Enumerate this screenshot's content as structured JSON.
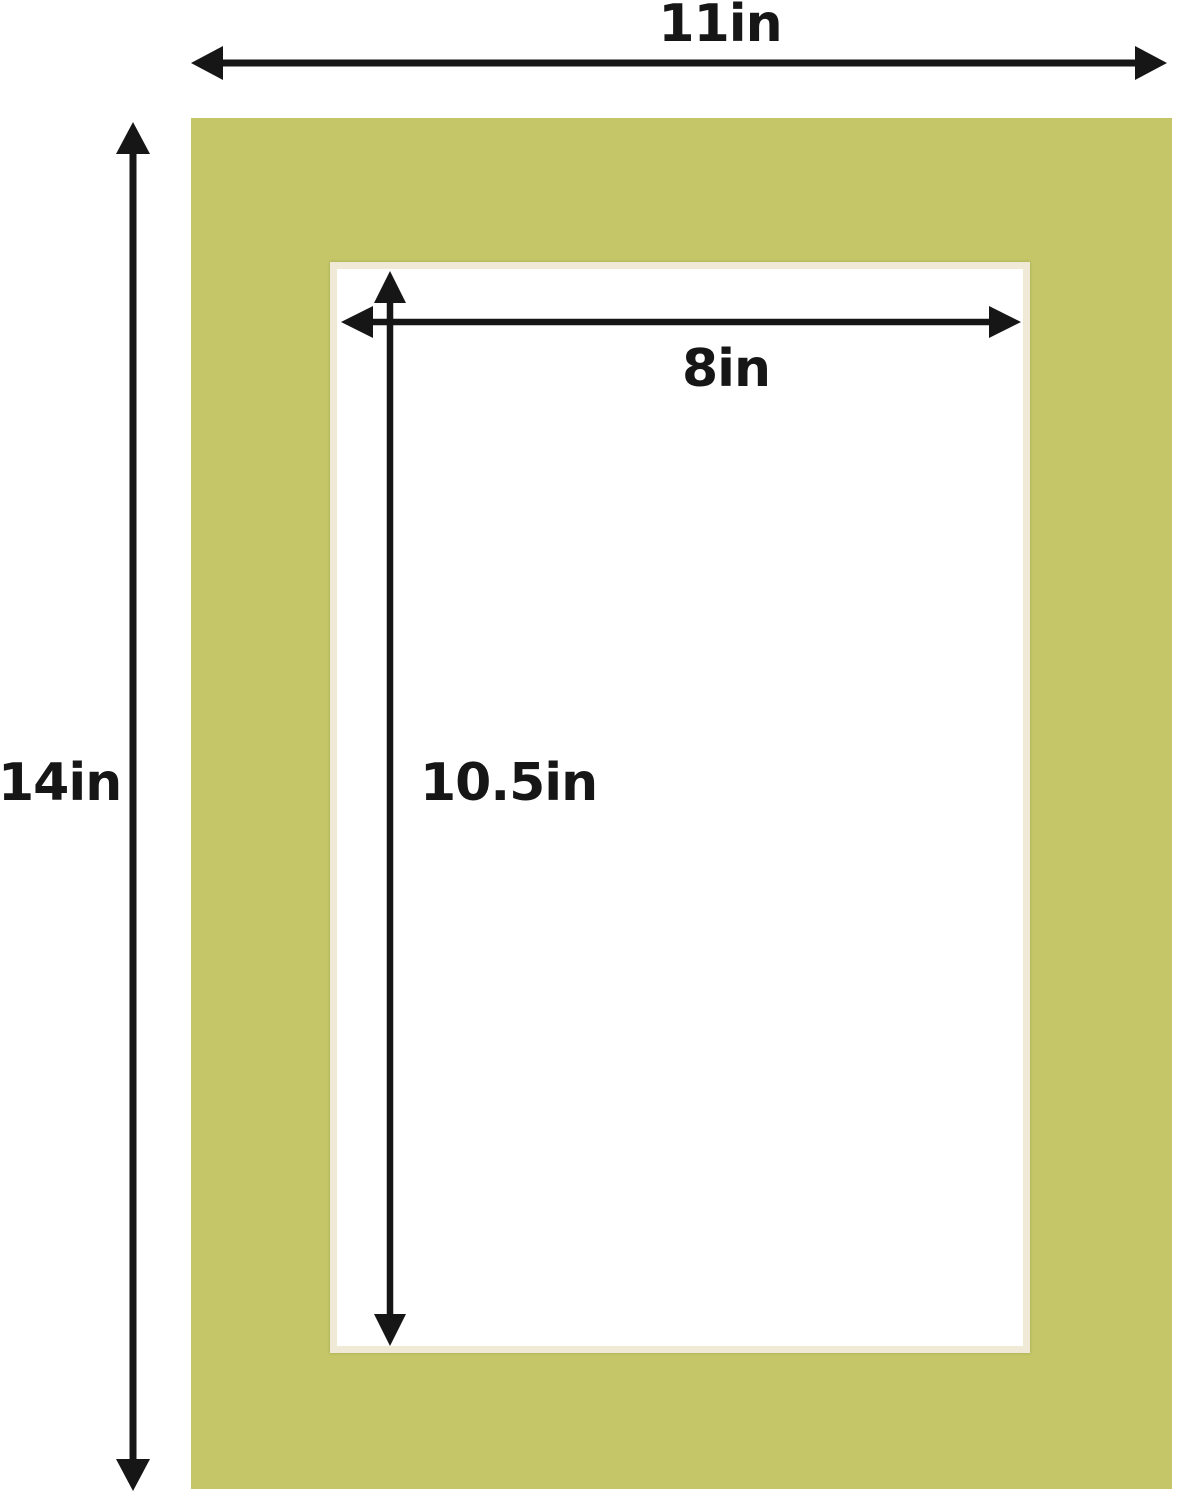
{
  "image": {
    "description": "Dimension diagram of a picture frame mat board with a rectangular cut opening",
    "type": "product-dimension-diagram"
  },
  "colors": {
    "mat-green": "#c4c668",
    "bevel-cream": "#efe9d6",
    "opening-white": "#ffffff",
    "annotation-black": "#161616",
    "background": "#ffffff"
  },
  "mat": {
    "material": "mat board",
    "outer_color_name": "yellow-green",
    "opening_color_name": "white"
  },
  "measurements": {
    "overall_width": {
      "label": "11in"
    },
    "overall_height": {
      "label": "14in"
    },
    "opening_width": {
      "label": "8in"
    },
    "opening_height": {
      "label": "10.5in"
    }
  }
}
